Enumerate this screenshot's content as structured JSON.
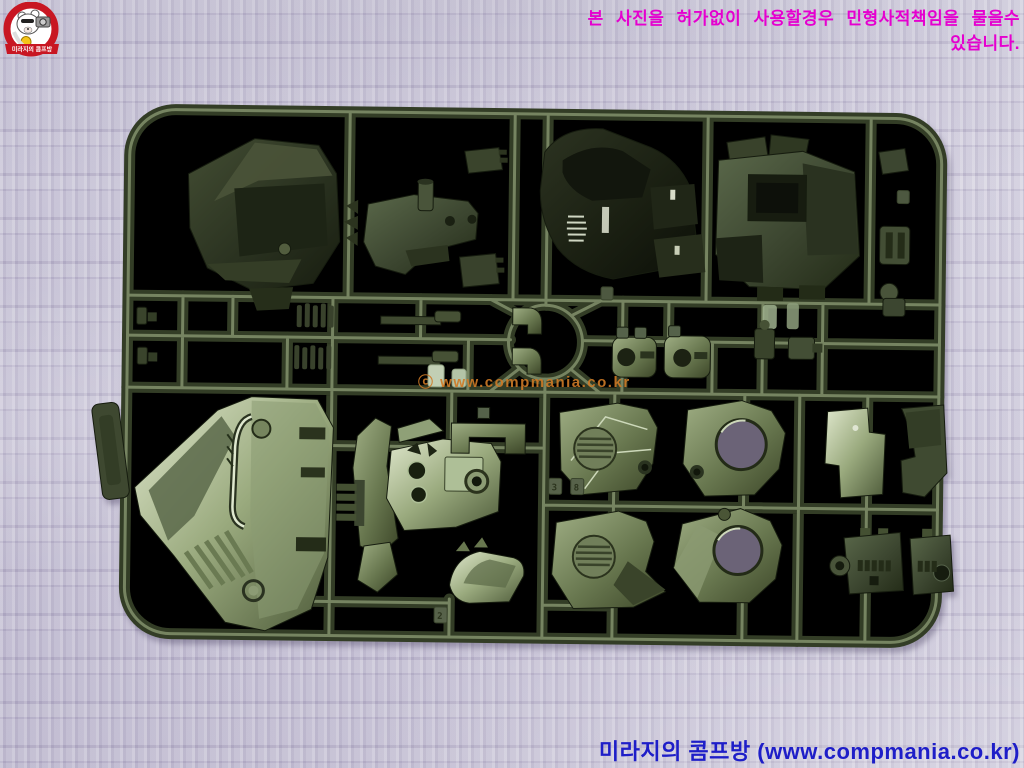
{
  "photo": {
    "alt": "Dark olive-green plastic model kit runner (sprue) with molded parts, lying on lavender quilted fabric"
  },
  "overlays": {
    "copyright_warning": "본 사진을 허가없이 사용할경우 민형사적책임을 물을수 있습니다.",
    "center_watermark": "ⓒ www.compmania.co.kr",
    "footer_site": "미라지의 콤프방 (www.compmania.co.kr)"
  },
  "logo": {
    "banner_text": "미라지의 콤프방"
  },
  "sprue": {
    "part_tags": [
      "3",
      "8",
      "2"
    ]
  },
  "colors": {
    "warning_text": "#e500cf",
    "footer_text": "#1e1ec8",
    "watermark_text": "#cf7a26",
    "fabric_base": "#c7c3d4",
    "plastic_dark": "#2a3220",
    "plastic_mid": "#49543a",
    "plastic_highlight": "#93a37b",
    "plastic_shine": "#dfe7cc",
    "logo_ring": "#c81622"
  }
}
